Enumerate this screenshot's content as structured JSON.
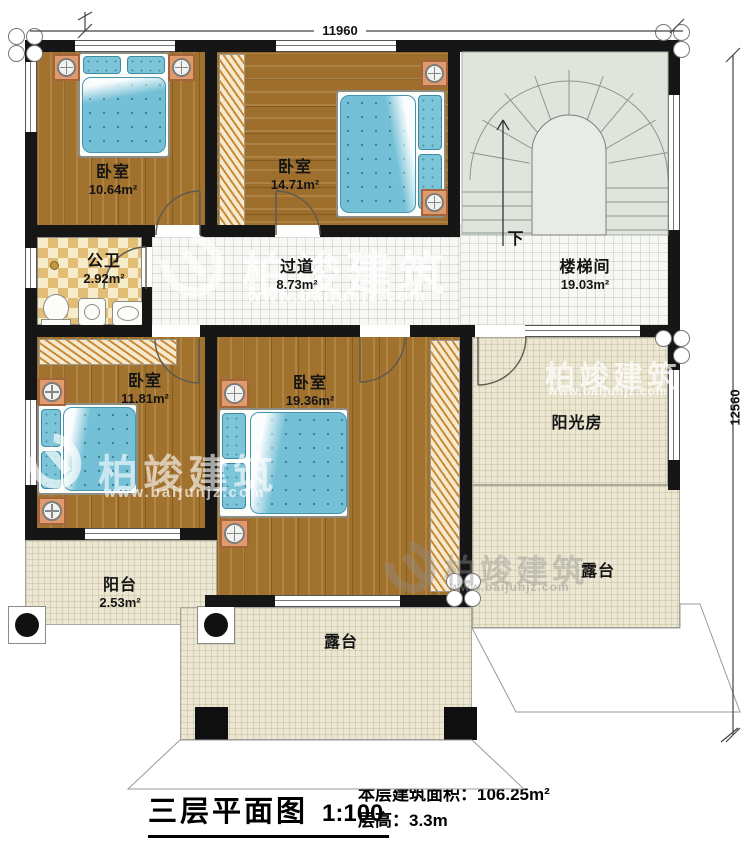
{
  "dimensions": {
    "top": "11960",
    "right": "12560"
  },
  "rooms": {
    "bedroom_top_left": {
      "name": "卧室",
      "area": "10.64m²"
    },
    "bedroom_top_mid": {
      "name": "卧室",
      "area": "14.71m²"
    },
    "bathroom": {
      "name": "公卫",
      "area": "2.92m²"
    },
    "corridor": {
      "name": "过道",
      "area": "8.73m²"
    },
    "stairwell": {
      "name": "楼梯间",
      "area": "19.03m²",
      "direction": "下"
    },
    "bedroom_bottom_left": {
      "name": "卧室",
      "area": "11.81m²"
    },
    "bedroom_bottom_mid": {
      "name": "卧室",
      "area": "19.36m²"
    },
    "sunroom": {
      "name": "阳光房"
    },
    "balcony": {
      "name": "阳台",
      "area": "2.53m²"
    },
    "terrace_right": {
      "name": "露台"
    },
    "terrace_bottom": {
      "name": "露台"
    }
  },
  "title": {
    "plan_name": "三层平面图",
    "scale": "1:100",
    "floor_area_label": "本层建筑面积：",
    "floor_area_value": "106.25m²",
    "floor_height_label": "层高：",
    "floor_height_value": "3.3m"
  },
  "watermark": {
    "brand": "柏竣建筑",
    "url": "www.baijunjz.com"
  },
  "colors": {
    "wall": "#161616",
    "wood_floor": "#a1722e",
    "mattress_blue": "#74c0d6",
    "cream_floor": "#ece7d3",
    "stair_floor": "#dfe4dc",
    "bath_checker": "#e2bd76",
    "white_tile": "#f7f7f3"
  }
}
